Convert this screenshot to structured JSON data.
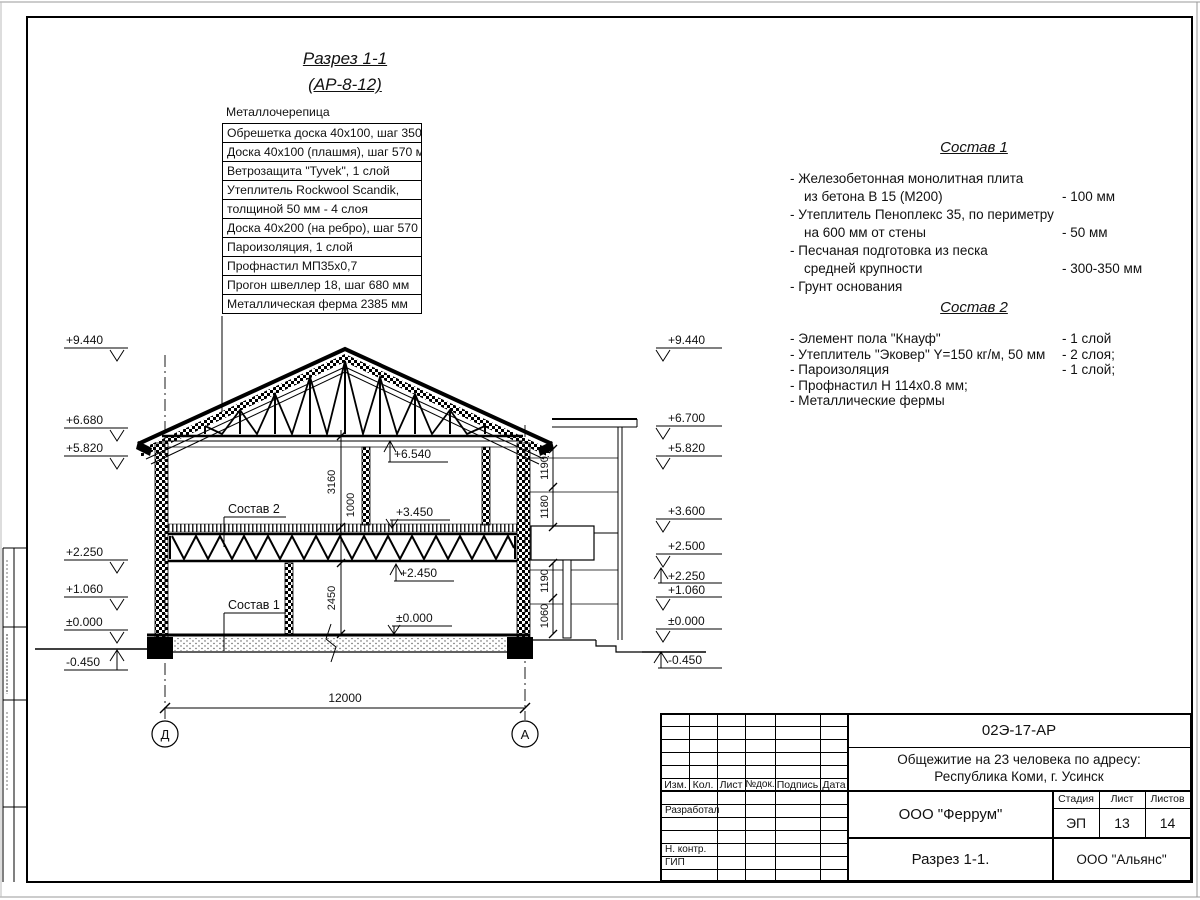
{
  "page_title": {
    "line1": "Разрез 1-1",
    "line2": "(АР-8-12)"
  },
  "callout": {
    "header": "Металлочерепица",
    "rows": [
      "Обрешетка доска 40х100, шаг 350 мм",
      "Доска 40х100 (плашмя), шаг 570 мм",
      "Ветрозащита \"Tyvek\", 1 слой",
      "Утеплитель Rockwool Scandik,",
      "толщиной 50 мм - 4 слоя",
      "Доска 40х200 (на ребро), шаг 570 мм",
      "Пароизоляция, 1 слой",
      "Профнастил МП35х0,7",
      "Прогон швеллер 18, шаг 680 мм",
      "Металлическая ферма 2385 мм"
    ]
  },
  "sostav1": {
    "title": "Состав 1",
    "lines": [
      {
        "t": "- Железобетонная  монолитная плита",
        "v": ""
      },
      {
        "t": "из бетона В 15 (М200)",
        "v": "- 100 мм"
      },
      {
        "t": "- Утеплитель Пеноплекс 35, по периметру",
        "v": ""
      },
      {
        "t": "на 600 мм от стены",
        "v": "- 50 мм"
      },
      {
        "t": "- Песчаная подготовка из песка",
        "v": ""
      },
      {
        "t": "средней крупности",
        "v": "- 300-350 мм"
      },
      {
        "t": "- Грунт основания",
        "v": ""
      }
    ]
  },
  "sostav2": {
    "title": "Состав 2",
    "lines": [
      {
        "t": "- Элемент пола \"Кнауф\"",
        "v": "- 1 слой"
      },
      {
        "t": "- Утеплитель \"Эковер\" Y=150 кг/м, 50 мм",
        "v": "- 2 слоя;"
      },
      {
        "t": "- Пароизоляция",
        "v": "- 1 слой;"
      },
      {
        "t": "- Профнастил Н 114х0.8 мм;",
        "v": ""
      },
      {
        "t": "- Металлические фермы",
        "v": ""
      }
    ]
  },
  "elev": {
    "left": [
      "+9.440",
      "+6.680",
      "+5.820",
      "+2.250",
      "+1.060",
      "±0.000",
      "-0.450"
    ],
    "right": [
      "+9.440",
      "+6.700",
      "+5.820",
      "+3.600",
      "+2.500",
      "+2.250",
      "+1.060",
      "±0.000",
      "-0.450"
    ]
  },
  "marks": {
    "ceiling": "+6.540",
    "floor2": "+3.450",
    "truss": "+2.450",
    "zero": "±0.000"
  },
  "dims": {
    "span": "12000",
    "h_upper": "3160",
    "h_truss": "1000",
    "h_lower": "2450",
    "r_up1": "1190",
    "r_up2": "1180",
    "r_low1": "1190",
    "r_low2": "1060"
  },
  "axes": {
    "left": "Д",
    "right": "А"
  },
  "labels": {
    "sostav1": "Состав 1",
    "sostav2": "Состав 2"
  },
  "titleblock": {
    "doc": "02Э-17-АР",
    "object1": "Общежитие на 23 человека по адресу:",
    "object2": "Республика Коми, г. Усинск",
    "cols": [
      "Изм.",
      "Кол.",
      "Лист",
      "№док.",
      "Подпись",
      "Дата"
    ],
    "roles": [
      "Разработал",
      "Н. контр.",
      "ГИП"
    ],
    "org": "ООО \"Феррум\"",
    "stage_h": "Стадия",
    "sheet_h": "Лист",
    "sheets_h": "Листов",
    "stage": "ЭП",
    "sheet": "13",
    "sheets": "14",
    "drawing": "Разрез 1-1.",
    "org2": "ООО \"Альянс\""
  }
}
